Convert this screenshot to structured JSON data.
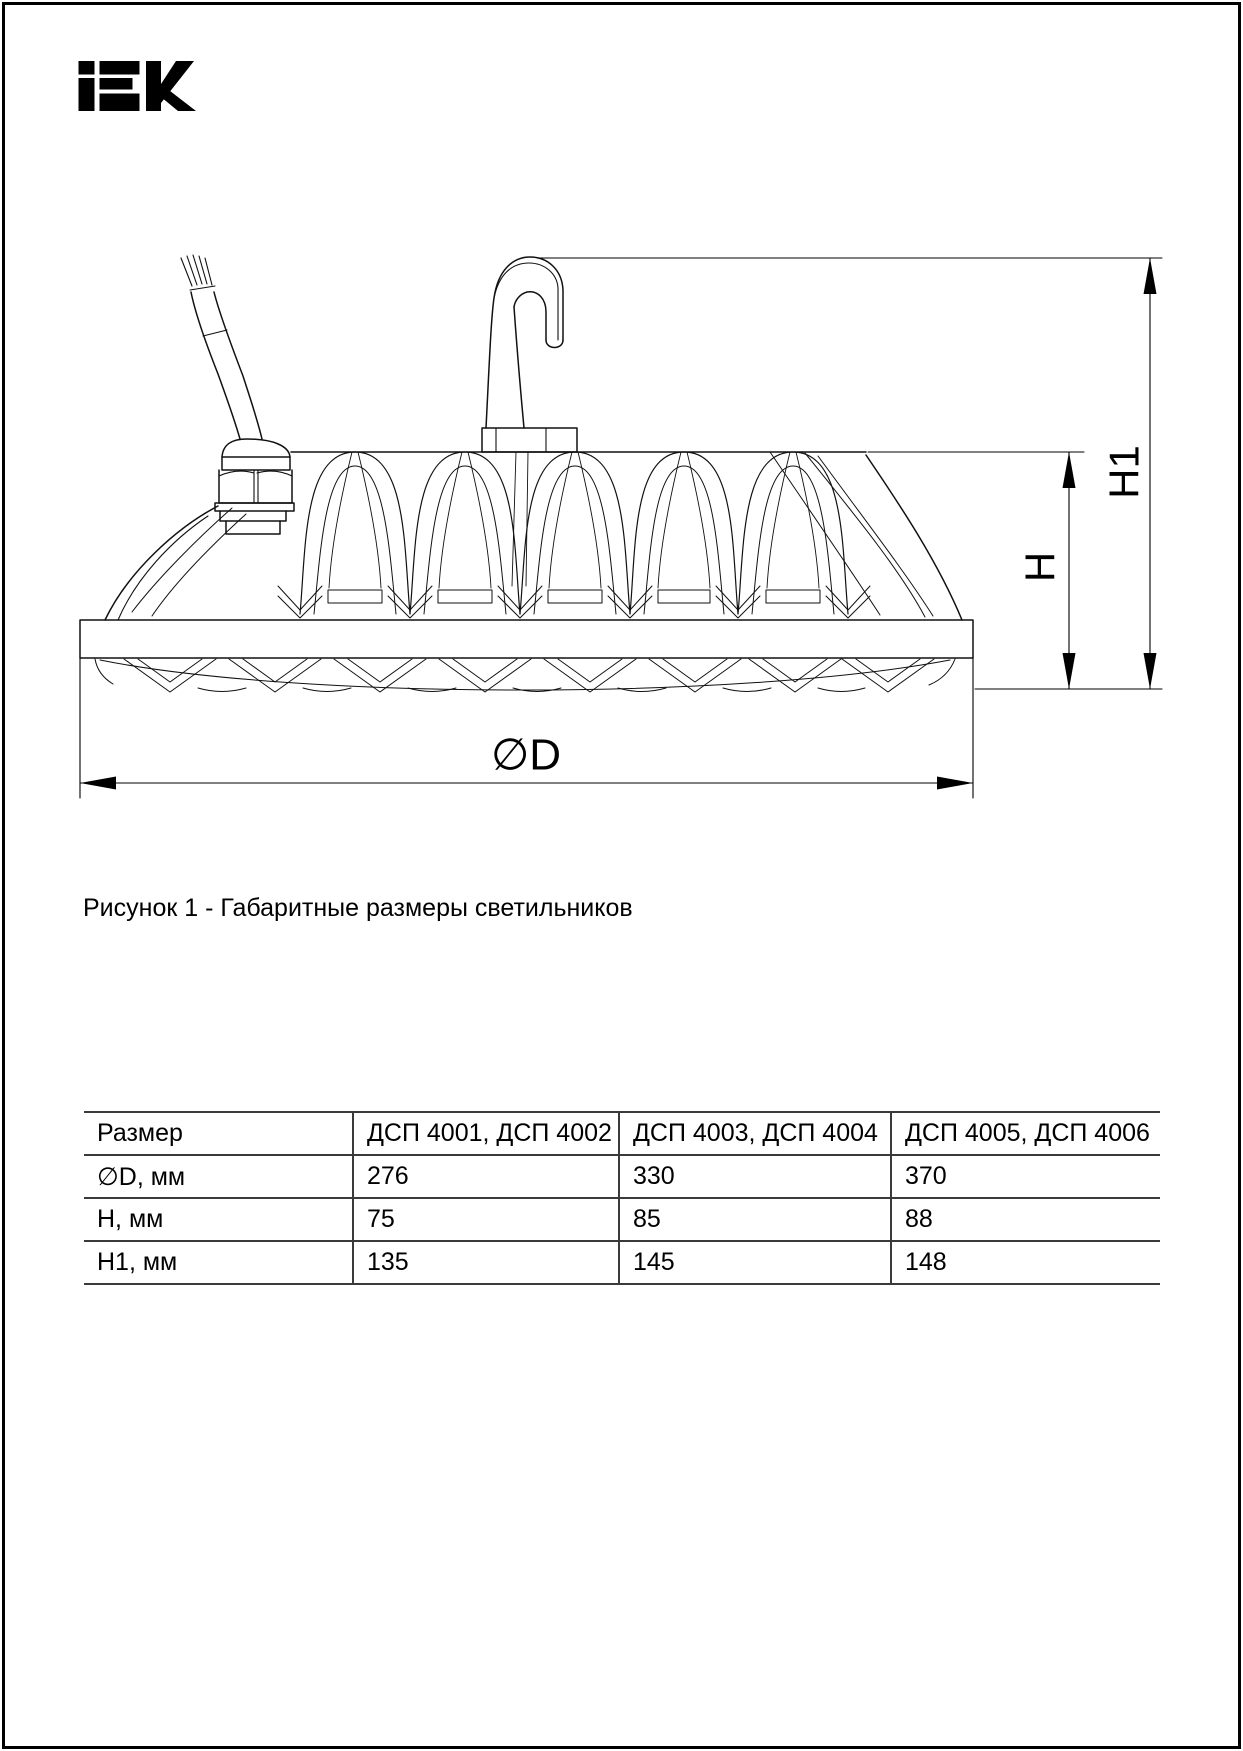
{
  "logo": {
    "text": "IEK"
  },
  "figure": {
    "caption": "Рисунок 1 - Габаритные размеры светильников",
    "dim_labels": {
      "h": "H",
      "h1": "H1",
      "d": "∅D"
    }
  },
  "table": {
    "headers": [
      "Размер",
      "ДСП 4001, ДСП 4002",
      "ДСП 4003, ДСП 4004",
      "ДСП 4005, ДСП 4006"
    ],
    "rows": [
      {
        "label": "∅D, мм",
        "values": [
          "276",
          "330",
          "370"
        ]
      },
      {
        "label": "H, мм",
        "values": [
          "75",
          "85",
          "88"
        ]
      },
      {
        "label": "H1, мм",
        "values": [
          "135",
          "145",
          "148"
        ]
      }
    ]
  }
}
